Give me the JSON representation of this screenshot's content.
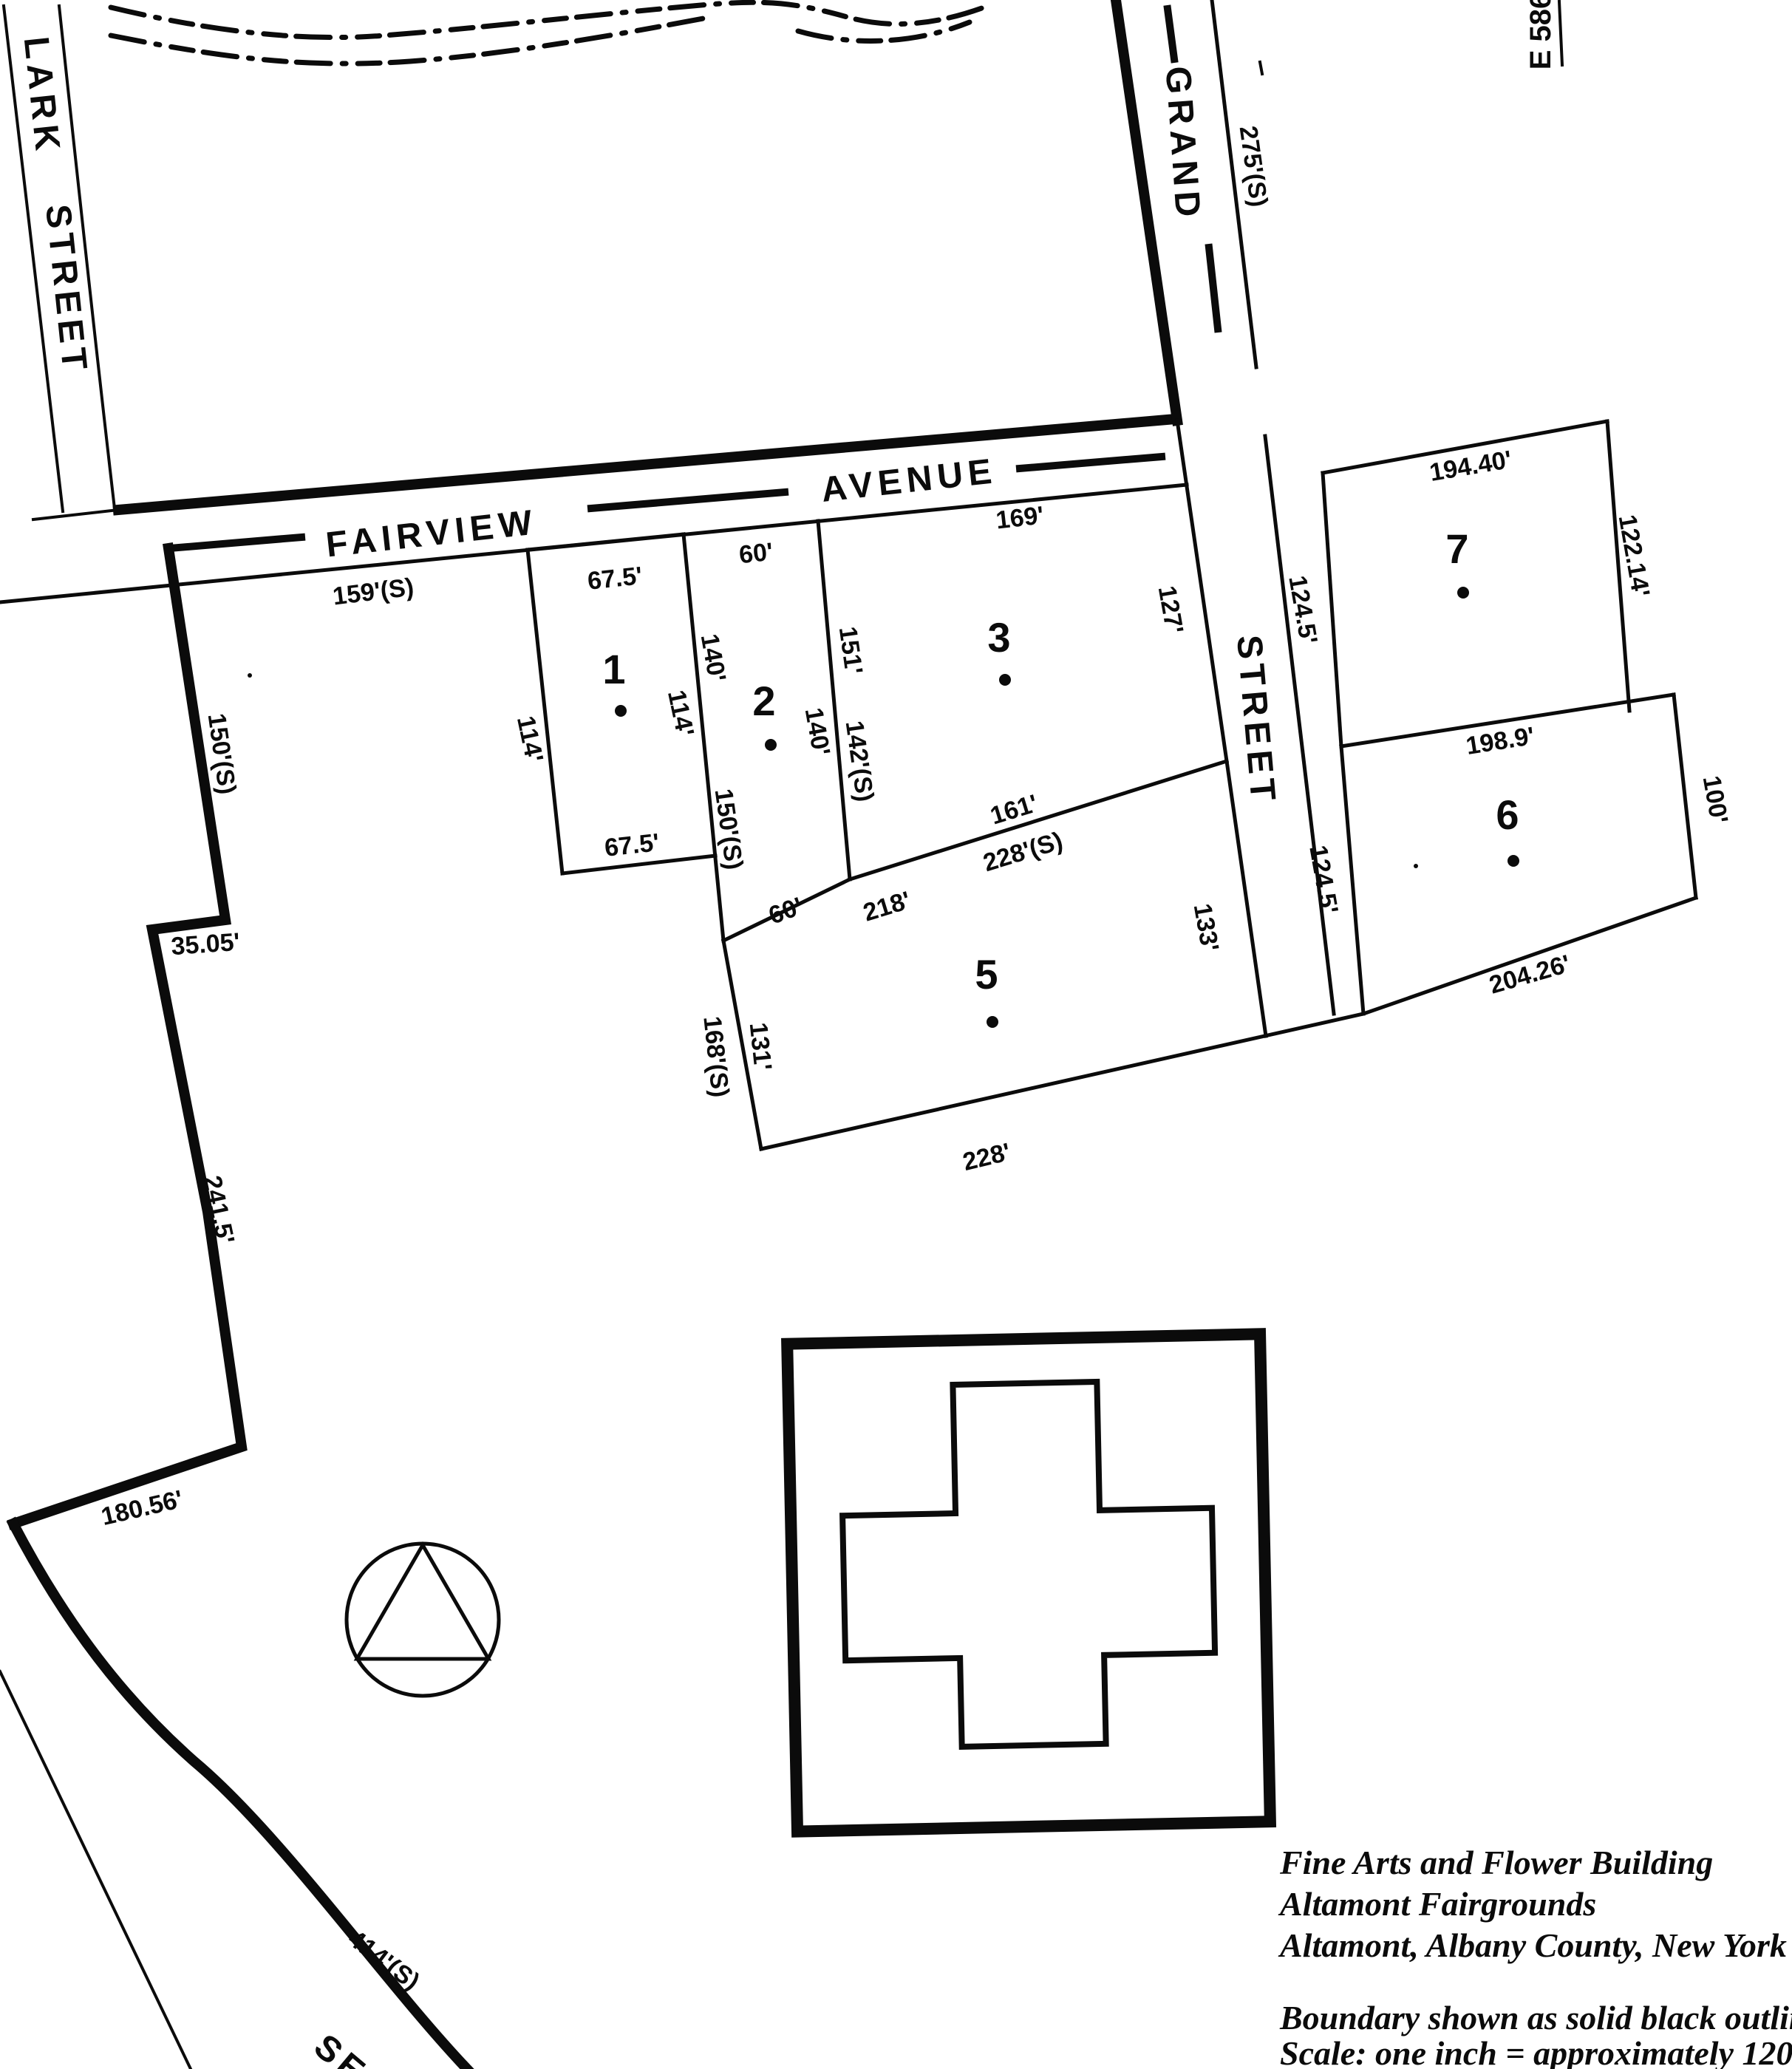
{
  "colors": {
    "ink": "#0b0b0b",
    "paper": "#ffffff"
  },
  "sheet_ref": "E 586",
  "streets": {
    "lark_line1": "LARK",
    "lark_line2": "STREET",
    "fairview_word1": "FAIRVIEW",
    "fairview_word2": "AVENUE",
    "grand_word1": "GRAND",
    "grand_word2": "STREET",
    "south_street_partial": "SE"
  },
  "frontages": {
    "fairview_south": "159'(S)",
    "grand_east": "275'(S)"
  },
  "west_boundary": {
    "seg_upper": "150'(S)",
    "jog": "35.05'",
    "seg_mid": "241.5'",
    "seg_lower": "180.56'",
    "street_frontage": "414'(S)"
  },
  "parcels": {
    "p1": {
      "number": "1",
      "top": "67.5'",
      "bottom": "67.5'",
      "west": "114'",
      "east": "114'"
    },
    "p2": {
      "number": "2",
      "top": "60'",
      "bottom": "60'",
      "west": "140'",
      "east": "140'",
      "west_south": "150'(S)"
    },
    "p3": {
      "number": "3",
      "top": "169'",
      "west_a": "151'",
      "west_b": "142'(S)",
      "east": "127'",
      "south_a": "161'",
      "south_b": "228'(S)",
      "south_c": "218'"
    },
    "p5": {
      "number": "5",
      "west_a": "168'(S)",
      "west_b": "131'",
      "south": "228'",
      "east": "133'"
    },
    "p6": {
      "number": "6",
      "top": "198.9'",
      "east": "100'",
      "south": "204.26'",
      "west": "124.5'"
    },
    "p7": {
      "number": "7",
      "top": "194.40'",
      "east": "122.14'",
      "west": "124.5'"
    }
  },
  "caption": {
    "line1": "Fine Arts and Flower Building",
    "line2": "Altamont Fairgrounds",
    "line3": "Altamont, Albany County, New York"
  },
  "legend": {
    "line1": "Boundary shown as solid black outline",
    "line2": "Scale: one inch = approximately 120'"
  }
}
